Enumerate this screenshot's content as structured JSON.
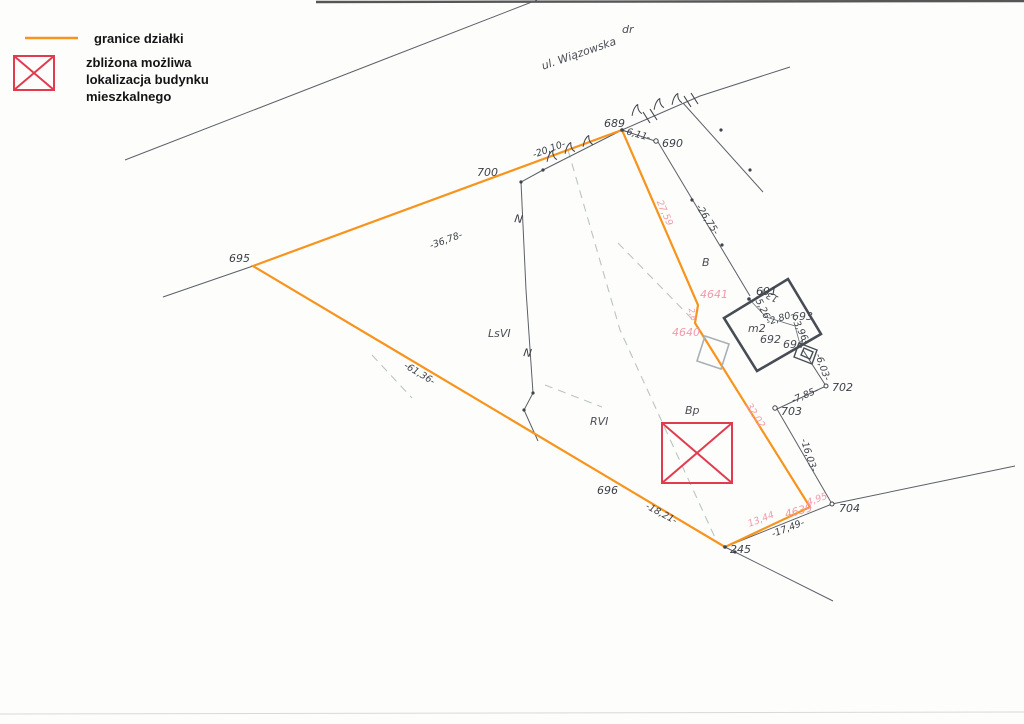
{
  "legend": {
    "items": [
      {
        "symbol": "orange-line",
        "label": "granice działki"
      },
      {
        "symbol": "red-crossed-box",
        "label_lines": [
          "zbliżona możliwa",
          "lokalizacja budynku",
          "mieszkalnego"
        ]
      }
    ]
  },
  "street": {
    "name": "ul. Wiązowska",
    "class_label": "dr"
  },
  "parcel_points": {
    "p245": "245",
    "p689": "689",
    "p690": "690",
    "p691": "691",
    "p692": "692",
    "p693": "693",
    "p694": "694",
    "p695": "695",
    "p696": "696",
    "p700": "700",
    "p702": "702",
    "p703": "703",
    "p704": "704"
  },
  "new_points": {
    "p4639": "4639",
    "p4640": "4640",
    "p4641": "4641"
  },
  "measurements": {
    "m36_78": "-36,78-",
    "m20_10": "-20,10-",
    "m6_11": "-6,11-",
    "m26_75": "-26,75-",
    "m5_26": "-5,26-",
    "m2_80": "-2,80-",
    "m3_96": "-3,96-",
    "m6_03": "-6,03-",
    "m7_85": "-7,85-",
    "m16_03": "-16,03-",
    "m17_49": "-17,49-",
    "m18_21": "-18,21-",
    "m61_36": "-61,36-"
  },
  "new_measurements": {
    "m27_59": "27,59",
    "m32_02": "32,02",
    "m4_95": "4,95",
    "m13_44": "13,44",
    "m2_6": "2,6"
  },
  "land_use": {
    "b": "B",
    "bp": "Bp",
    "rvi": "RVI",
    "lsvi": "LsVI"
  },
  "building": {
    "address": "13A",
    "type_label": "m2"
  },
  "symbols": {
    "fence_mark": "N"
  },
  "colors": {
    "boundary_orange": "#f7941d",
    "proposed_building_red": "#e23b4e",
    "new_point_pink": "#f29aa9",
    "line_gray": "#5b6067",
    "classification_dash": "#b9c6be"
  }
}
